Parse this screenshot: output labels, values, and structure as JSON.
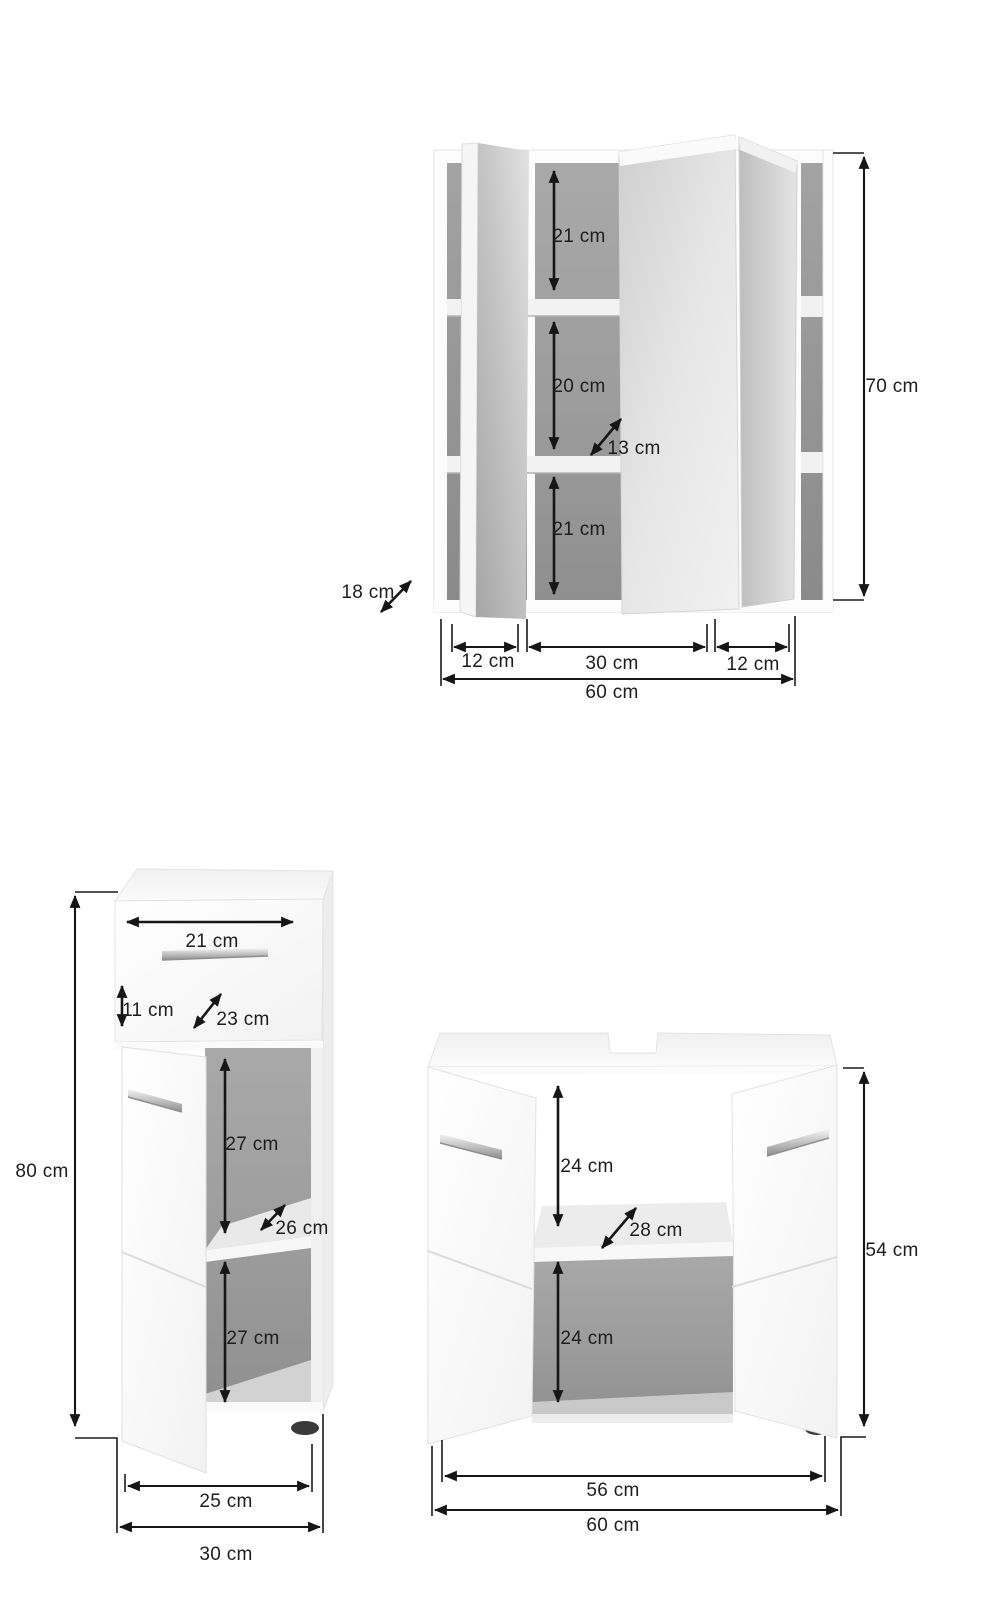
{
  "diagram": {
    "kind": "furniture-dimension-diagram",
    "units": "cm",
    "colors": {
      "line": "#161616",
      "text": "#1d1d1d",
      "interior_gray": "#9a9a9a",
      "mirror_gray": "#d9d9d9",
      "cabinet_white": "#fcfcfc"
    },
    "figures": {
      "mirror_cabinet": {
        "labels": {
          "compartment_top": "21 cm",
          "compartment_middle": "20 cm",
          "inner_depth": "13 cm",
          "compartment_bottom": "21 cm",
          "height": "70 cm",
          "depth": "18 cm",
          "door_left_width": "12 cm",
          "door_middle_width": "30 cm",
          "door_right_width": "12 cm",
          "total_width": "60 cm"
        }
      },
      "base_cabinet": {
        "labels": {
          "drawer_width": "21 cm",
          "drawer_height": "11 cm",
          "drawer_depth": "23 cm",
          "compartment_top": "27 cm",
          "inner_depth": "26 cm",
          "compartment_bottom": "27 cm",
          "height": "80 cm",
          "door_width": "25 cm",
          "total_width": "30 cm"
        }
      },
      "washbasin_cabinet": {
        "labels": {
          "compartment_top": "24 cm",
          "inner_depth": "28 cm",
          "compartment_bottom": "24 cm",
          "height": "54 cm",
          "inner_width": "56 cm",
          "total_width": "60 cm"
        }
      }
    }
  }
}
